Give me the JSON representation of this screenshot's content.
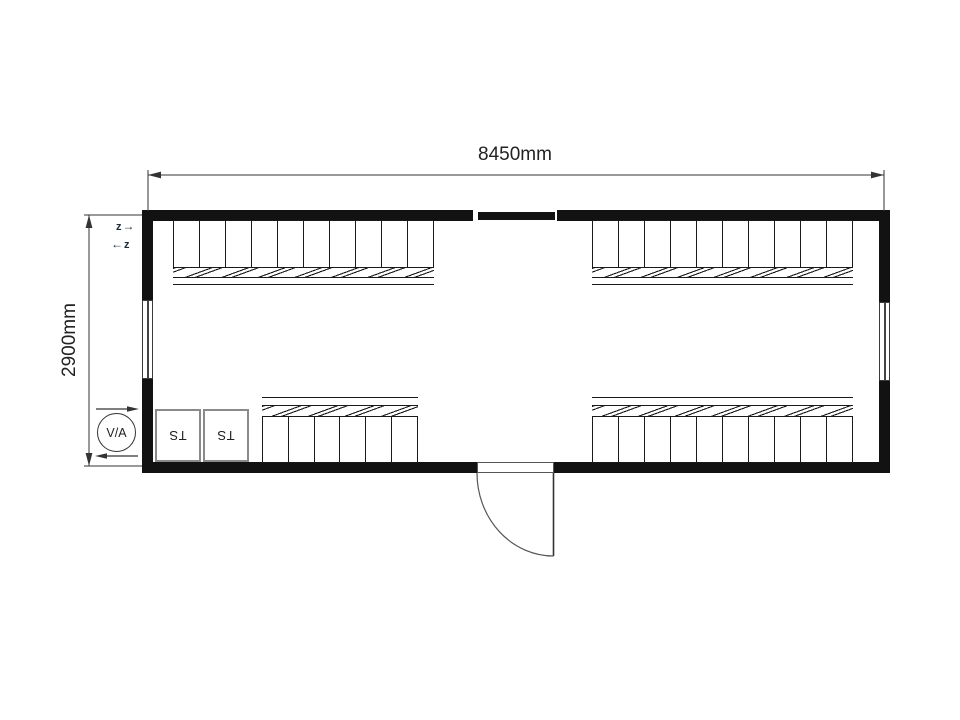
{
  "dimension_labels": {
    "width": "8450mm",
    "height": "2900mm"
  },
  "labels": {
    "ventilation_circle": "V/A",
    "ts_box_1": "TS",
    "ts_box_2": "TS"
  },
  "symbols": {
    "z_top": "z",
    "z_bottom": "z",
    "arrow_right": "→",
    "arrow_left": "←"
  },
  "locker_groups": [
    {
      "id": "top-left",
      "count": 10
    },
    {
      "id": "top-right",
      "count": 10
    },
    {
      "id": "bottom-left",
      "count": 6
    },
    {
      "id": "bottom-right",
      "count": 10
    }
  ],
  "fixtures": {
    "door": "swing-door-bottom-center",
    "windows": [
      "left-wall-window",
      "right-wall-window",
      "top-wall-window"
    ]
  },
  "colors": {
    "wall": "#121212",
    "line": "#333333",
    "symbol": "#1e2b3c",
    "ts_border": "#8a8a8a"
  }
}
